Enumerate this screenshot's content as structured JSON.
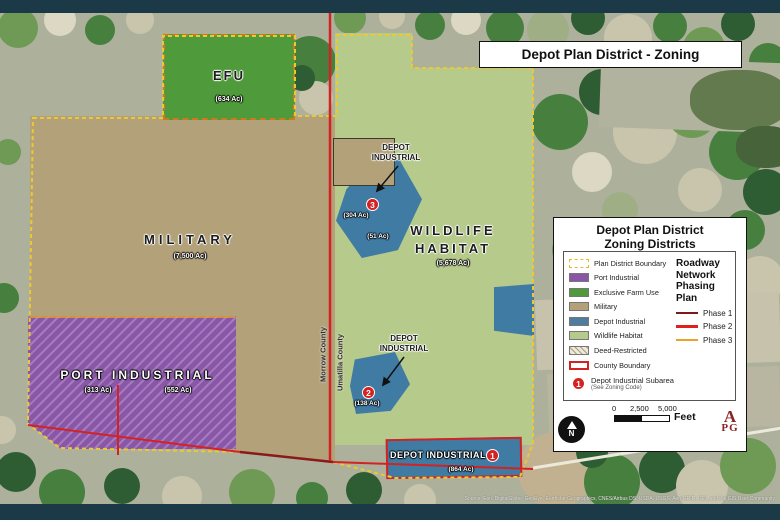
{
  "header": {
    "title": "Depot Plan District - Zoning"
  },
  "zones": {
    "efu": {
      "name": "EFU",
      "acres": "(634 Ac)"
    },
    "military": {
      "name": "MILITARY",
      "acres": "(7,500 Ac)"
    },
    "wildlife_habitat": {
      "name": "WILDLIFE HABITAT",
      "acres": "(5,678 Ac)"
    },
    "port_industrial": {
      "name": "PORT INDUSTRIAL",
      "acres_west": "(313 Ac)",
      "acres_east": "(552 Ac)"
    },
    "depot_industrial_3": {
      "label": "DEPOT INDUSTRIAL",
      "subarea": "3",
      "acres": "(304 Ac)",
      "acres_adjacent": "(51 Ac)"
    },
    "depot_industrial_2": {
      "label": "DEPOT INDUSTRIAL",
      "subarea": "2",
      "acres": "(138 Ac)"
    },
    "depot_industrial_1": {
      "label": "DEPOT INDUSTRIAL",
      "subarea": "1",
      "acres": "(864 Ac)"
    }
  },
  "counties": {
    "west": "Morrow County",
    "east": "Umatilla County"
  },
  "legend": {
    "title_line1": "Depot Plan District",
    "title_line2": "Zoning Districts",
    "items": [
      {
        "label": "Plan District Boundary"
      },
      {
        "label": "Port Industrial"
      },
      {
        "label": "Exclusive Farm Use"
      },
      {
        "label": "Military"
      },
      {
        "label": "Depot Industrial"
      },
      {
        "label": "Wildlife Habitat"
      },
      {
        "label": "Deed-Restricted"
      },
      {
        "label": "County Boundary"
      }
    ],
    "subarea_note": {
      "marker": "1",
      "label": "Depot Industrial Subarea",
      "sublabel": "(See Zoning Code)"
    },
    "roadway": {
      "title": "Roadway Network Phasing Plan",
      "phases": [
        {
          "label": "Phase 1"
        },
        {
          "label": "Phase 2"
        },
        {
          "label": "Phase 3"
        }
      ]
    },
    "scale_bar": {
      "tick0": "0",
      "tick1": "2,500",
      "tick2": "5,000",
      "unit": "Feet"
    },
    "logo_line1": "A",
    "logo_line2": "PG"
  },
  "credits": "Source: Esri, DigitalGlobe, GeoEye, Earthstar Geographics, CNES/Airbus DS, USDA, USGS, AeroGRID, IGN, and the GIS User Community",
  "colors": {
    "port_industrial": "#8a56a8",
    "exclusive_farm_use": "#4f9a3a",
    "military": "#b3a17a",
    "depot_industrial": "#4f7da0",
    "wildlife_habitat": "#b6ca8c",
    "plan_district_boundary": "#e8c52c",
    "county_boundary": "#d42222",
    "phase1": "#7a1a1a",
    "phase2": "#e02020",
    "phase3": "#e8a428",
    "subarea_marker": "#d42222",
    "frame_bar": "#1b3946"
  }
}
